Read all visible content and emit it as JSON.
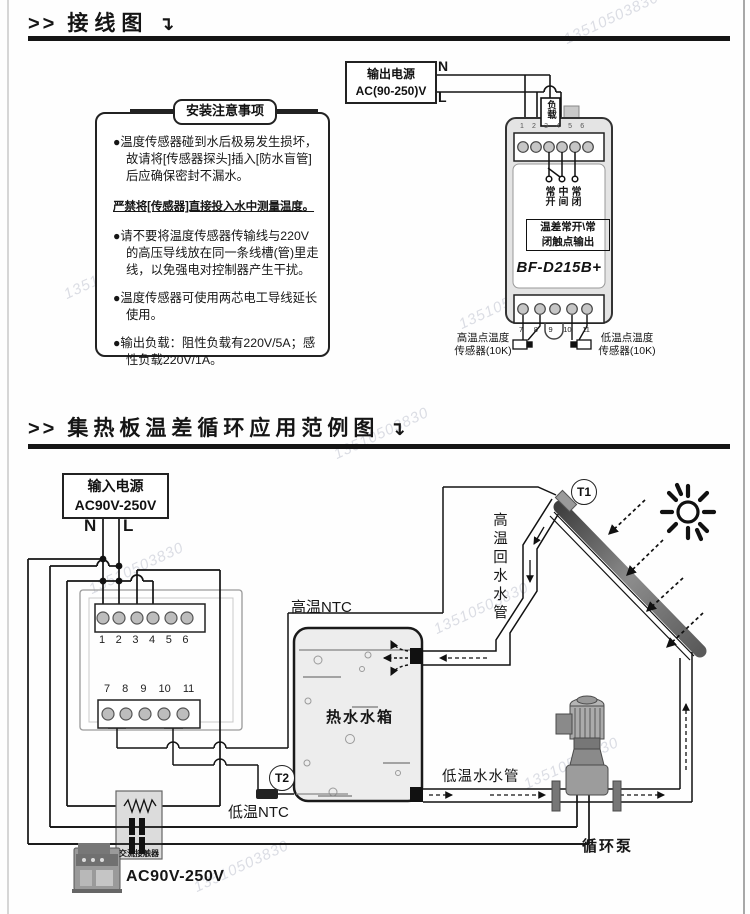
{
  "watermark": "13510503830",
  "section1": {
    "title_prefix": ">>",
    "title": "接线图",
    "title_arrow": "↴",
    "notes": {
      "title": "安装注意事项",
      "item1": "●温度传感器碰到水后极易发生损坏，故请将[传感器探头]插入[防水盲管]后应确保密封不漏水。",
      "warning": "严禁将[传感器]直接投入水中测量温度。",
      "item2": "●请不要将温度传感器传输线与220V的高压导线放在同一条线槽(管)里走线，以免强电对控制器产生干扰。",
      "item3": "●温度传感器可使用两芯电工导线延长使用。",
      "item4": "●输出负载：阻性负载有220V/5A；感性负载220V/1A。"
    },
    "power_box": {
      "line1": "输出电源",
      "line2": "AC(90-250)V"
    },
    "n_label": "N",
    "l_label": "L",
    "load_label": "负载",
    "device": {
      "model": "BF-D215B+",
      "terminals_top": "1 2 3 4 5 6",
      "terminals_bottom": "7 8 9 10 11",
      "contact_no": "常开",
      "contact_com": "中间",
      "contact_nc": "常闭",
      "output_box_line1": "温差常开\\常",
      "output_box_line2": "闭触点输出",
      "sensor_left_line1": "高温点温度",
      "sensor_left_line2": "传感器(10K)",
      "sensor_right_line1": "低温点温度",
      "sensor_right_line2": "传感器(10K)"
    }
  },
  "section2": {
    "title_prefix": ">>",
    "title": "集热板温差循环应用范例图",
    "title_arrow": "↴",
    "power_box": {
      "line1": "输入电源",
      "line2": "AC90V-250V"
    },
    "n_label": "N",
    "l_label": "L",
    "terminals_top": "1 2 3 4 5 6",
    "terminals_bottom": "7 8 9 10 11",
    "labels": {
      "high_ntc": "高温NTC",
      "low_ntc": "低温NTC",
      "t1": "T1",
      "t2": "T2",
      "tank": "热水水箱",
      "return_pipe": "高温回水水管",
      "cold_pipe": "低温水水管",
      "pump": "循环泵",
      "contactor": "交流接触器",
      "contactor_voltage": "AC90V-250V"
    }
  }
}
